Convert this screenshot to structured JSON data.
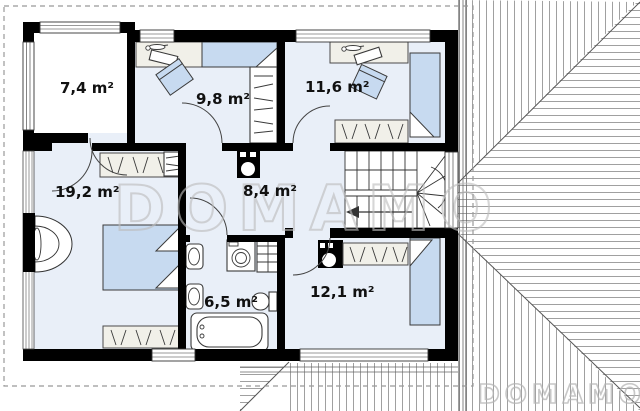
{
  "watermark": {
    "large": "DOMAMO",
    "small": "DOMAMO"
  },
  "rooms": [
    {
      "id": "room-7-4",
      "label": "7,4 m²"
    },
    {
      "id": "room-9-8",
      "label": "9,8 m²"
    },
    {
      "id": "room-11-6",
      "label": "11,6 m²"
    },
    {
      "id": "room-19-2",
      "label": "19,2 m²"
    },
    {
      "id": "hall-8-4",
      "label": "8,4 m²"
    },
    {
      "id": "bath-6-5",
      "label": "6,5 m²"
    },
    {
      "id": "room-12-1",
      "label": "12,1 m²"
    }
  ],
  "colors": {
    "floor": "#e9eff8",
    "furniture_blue": "#c7daf0",
    "furniture_gray": "#f1f0e9",
    "wall": "#000000",
    "roof_line": "#666666",
    "boundary_dash": "#999999",
    "watermark": "#bdbdbd"
  }
}
